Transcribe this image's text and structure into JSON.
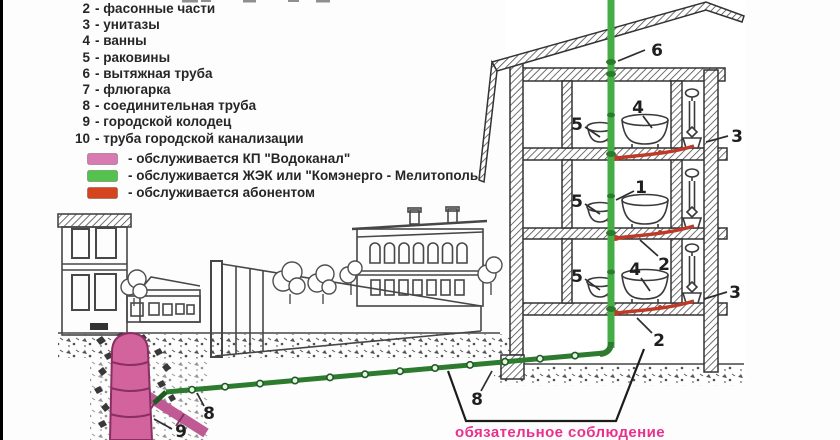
{
  "page": {
    "bottom_note": "обязательное соблюдение"
  },
  "legend_items": [
    {
      "num": "2",
      "label": "- фасонные части"
    },
    {
      "num": "3",
      "label": "- унитазы"
    },
    {
      "num": "4",
      "label": "- ванны"
    },
    {
      "num": "5",
      "label": "- раковины"
    },
    {
      "num": "6",
      "label": "- вытяжная труба"
    },
    {
      "num": "7",
      "label": "- флюгарка"
    },
    {
      "num": "8",
      "label": "- соединительная труба"
    },
    {
      "num": "9",
      "label": "- городской колодец"
    },
    {
      "num": "10",
      "label": "- труба городской канализации"
    }
  ],
  "service_legend": [
    {
      "color": "#d97ab2",
      "label": "- обслуживается КП \"Водоканал\""
    },
    {
      "color": "#54c24c",
      "label": "- обслуживается ЖЭК или \"Комэнерго - Мелитополь\""
    },
    {
      "color": "#d5431f",
      "label": "- обслуживается абонентом"
    }
  ],
  "callouts": [
    "6",
    "5",
    "4",
    "3",
    "5",
    "1",
    "2",
    "5",
    "4",
    "3",
    "2",
    "8",
    "8",
    "9"
  ],
  "colors": {
    "riser_green": "#46ad46",
    "buried_pipe_green": "#2d7b2f",
    "abonent_red": "#bf3a26",
    "well_pink": "#d2639c",
    "note_pink": "#ea2f8f"
  }
}
